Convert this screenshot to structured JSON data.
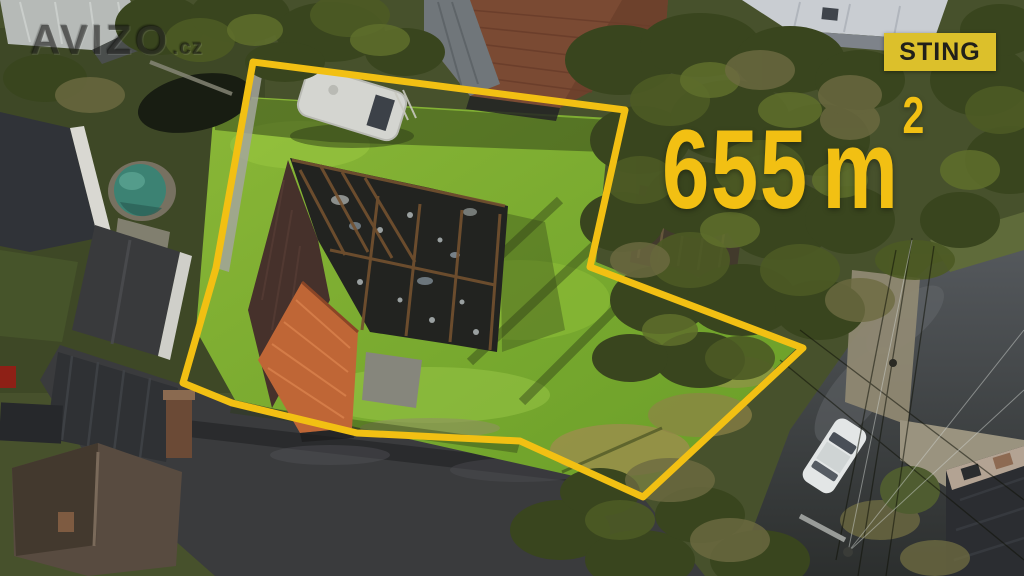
{
  "accent_color": "#f2c013",
  "watermark": {
    "brand": "AVIZO",
    "tld": ".cz"
  },
  "agency_badge": {
    "label": "STING",
    "bg": "#dcc02b",
    "fg": "#21201a"
  },
  "area_label": {
    "value": "655",
    "unit": "m",
    "exponent": "2",
    "color": "#f2c013"
  },
  "property_outline": {
    "color": "#f2c013",
    "stroke_width": 7,
    "points": [
      [
        253,
        62
      ],
      [
        625,
        110
      ],
      [
        590,
        267
      ],
      [
        803,
        348
      ],
      [
        643,
        497
      ],
      [
        520,
        441
      ],
      [
        357,
        433
      ],
      [
        232,
        403
      ],
      [
        183,
        383
      ],
      [
        216,
        268
      ]
    ]
  }
}
